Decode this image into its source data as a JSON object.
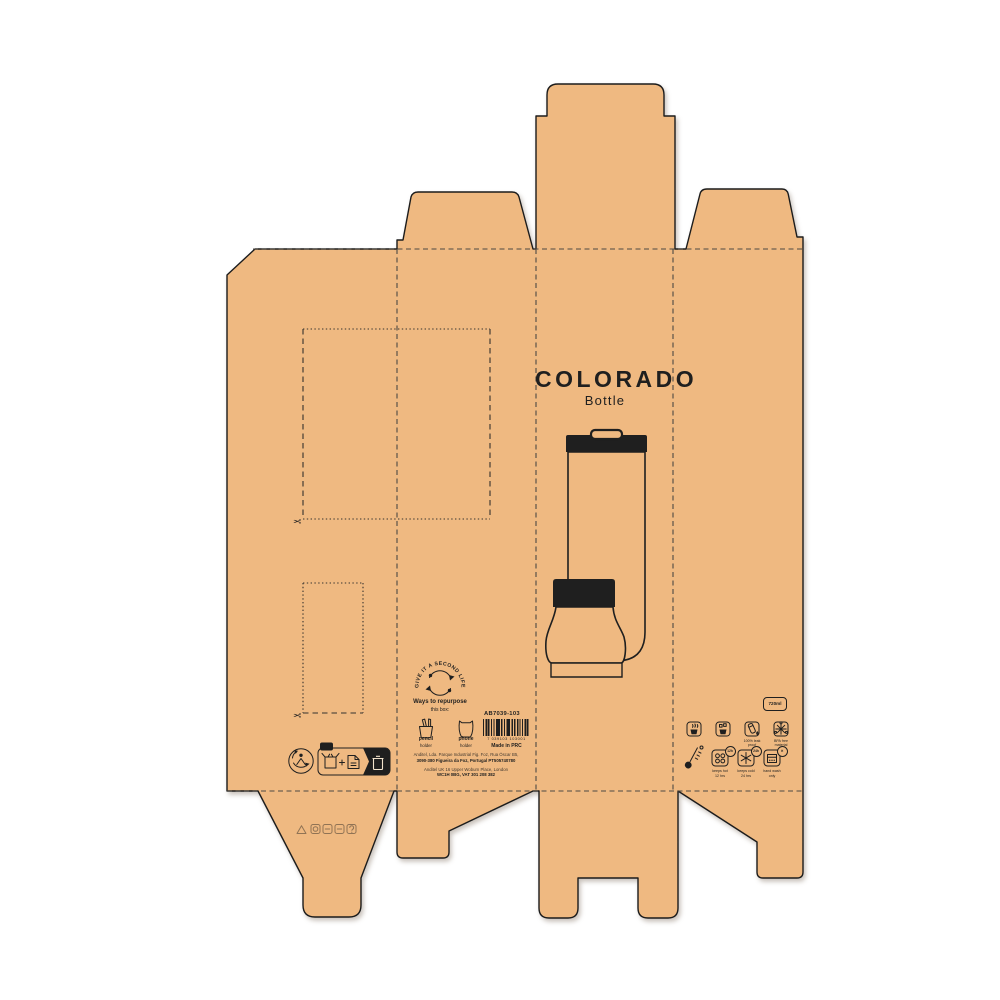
{
  "product": {
    "title": "COLORADO",
    "subtitle": "Bottle"
  },
  "repurpose": {
    "circle_text": "GIVE IT A SECOND LIFE",
    "heading": "Ways to repurpose",
    "subheading": "this box:",
    "items": [
      {
        "label": "pencil",
        "sublabel": "holder"
      },
      {
        "label": "phone",
        "sublabel": "holder"
      }
    ]
  },
  "production": {
    "code": "AB7039-103",
    "barcode_digits": "7 039103 103001",
    "made_in": "Made in PRC"
  },
  "address": {
    "line1": "Anditel, Lda. Parque Industrial Fig. Foz, Rua Óscar B5,",
    "line2": "3090-380 Figueira da Foz, Portugal PT505740780",
    "line3": "Anditel UK 16 Upper Woburn Place, London",
    "line4": "WC1H 0BG, VAT 301 208 382"
  },
  "care": {
    "capacity": "720ml",
    "leak_caption": [
      "100% leak",
      "proof"
    ],
    "bpa_caption": [
      "BPA free",
      "material"
    ],
    "hot_caption": [
      "keeps hot",
      "12 hrs"
    ],
    "cold_caption": [
      "keeps cold",
      "24 hrs"
    ],
    "wash_caption": [
      "hand wash",
      "only"
    ],
    "badges": {
      "hot": "12h",
      "cold": "24h",
      "wash": "✕"
    }
  },
  "icons": {
    "scissors": "✂"
  },
  "colors": {
    "kraft": "#efb981",
    "line": "#1f1f1f"
  }
}
